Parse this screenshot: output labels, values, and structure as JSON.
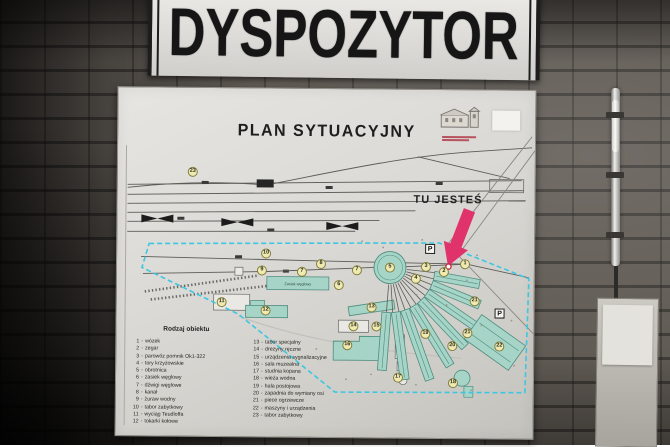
{
  "top_sign": {
    "title": "DYSPOZYTOR"
  },
  "board": {
    "title": "PLAN SYTUACYJNY",
    "you_are_here": "TU JESTEŚ",
    "parking_label": "P",
    "map_labels": {
      "coal_bunker": "Zasiek węglowy"
    },
    "markers": [
      {
        "n": "23",
        "x": 75,
        "y": 84
      },
      {
        "n": "10",
        "x": 149,
        "y": 165
      },
      {
        "n": "9",
        "x": 145,
        "y": 182
      },
      {
        "n": "8",
        "x": 204,
        "y": 175
      },
      {
        "n": "7",
        "x": 185,
        "y": 183
      },
      {
        "n": "7",
        "x": 240,
        "y": 181
      },
      {
        "n": "6",
        "x": 222,
        "y": 196
      },
      {
        "n": "5",
        "x": 273,
        "y": 178
      },
      {
        "n": "4",
        "x": 299,
        "y": 189
      },
      {
        "n": "3",
        "x": 309,
        "y": 177
      },
      {
        "n": "2",
        "x": 327,
        "y": 182
      },
      {
        "n": "1",
        "x": 348,
        "y": 174
      },
      {
        "n": "11",
        "x": 105,
        "y": 214
      },
      {
        "n": "12",
        "x": 149,
        "y": 222
      },
      {
        "n": "13",
        "x": 255,
        "y": 218
      },
      {
        "n": "14",
        "x": 237,
        "y": 237
      },
      {
        "n": "15",
        "x": 260,
        "y": 237
      },
      {
        "n": "16",
        "x": 231,
        "y": 256
      },
      {
        "n": "17",
        "x": 282,
        "y": 288
      },
      {
        "n": "18",
        "x": 337,
        "y": 293
      },
      {
        "n": "19",
        "x": 309,
        "y": 244
      },
      {
        "n": "20",
        "x": 336,
        "y": 256
      },
      {
        "n": "21",
        "x": 358,
        "y": 211
      },
      {
        "n": "21",
        "x": 351,
        "y": 243
      },
      {
        "n": "22",
        "x": 383,
        "y": 256
      }
    ],
    "parking": [
      {
        "x": 313,
        "y": 159
      },
      {
        "x": 383,
        "y": 223
      }
    ],
    "legend": {
      "title": "Rodzaj obiektu",
      "columns": [
        [
          {
            "num": "1",
            "label": "wózek"
          },
          {
            "num": "2",
            "label": "zegar"
          },
          {
            "num": "3",
            "label": "parowóz pomnik Ok1-322"
          },
          {
            "num": "4",
            "label": "tory krzyżowskie"
          },
          {
            "num": "5",
            "label": "obrotnica"
          },
          {
            "num": "6",
            "label": "zasiek węglowy"
          },
          {
            "num": "7",
            "label": "dźwigi węglowe"
          },
          {
            "num": "8",
            "label": "kanał"
          },
          {
            "num": "9",
            "label": "żuraw wodny"
          },
          {
            "num": "10",
            "label": "tabor zabytkowy"
          },
          {
            "num": "11",
            "label": "wyciąg Teudloffa"
          },
          {
            "num": "12",
            "label": "tokarki kołowe"
          }
        ],
        [
          {
            "num": "13",
            "label": "tabor specjalny"
          },
          {
            "num": "14",
            "label": "drezyny ręczne"
          },
          {
            "num": "15",
            "label": "urządzenia sygnalizacyjne"
          },
          {
            "num": "16",
            "label": "sala muzealna"
          },
          {
            "num": "17",
            "label": "studnia kopana"
          },
          {
            "num": "18",
            "label": "wieża wodna"
          },
          {
            "num": "19",
            "label": "hala postojowa"
          },
          {
            "num": "20",
            "label": "zapadnia do wymiany osi"
          },
          {
            "num": "21",
            "label": "piece ogrzewcze"
          },
          {
            "num": "22",
            "label": "maszyny i urządzenia"
          },
          {
            "num": "23",
            "label": "tabor zabytkowy"
          }
        ]
      ]
    }
  }
}
